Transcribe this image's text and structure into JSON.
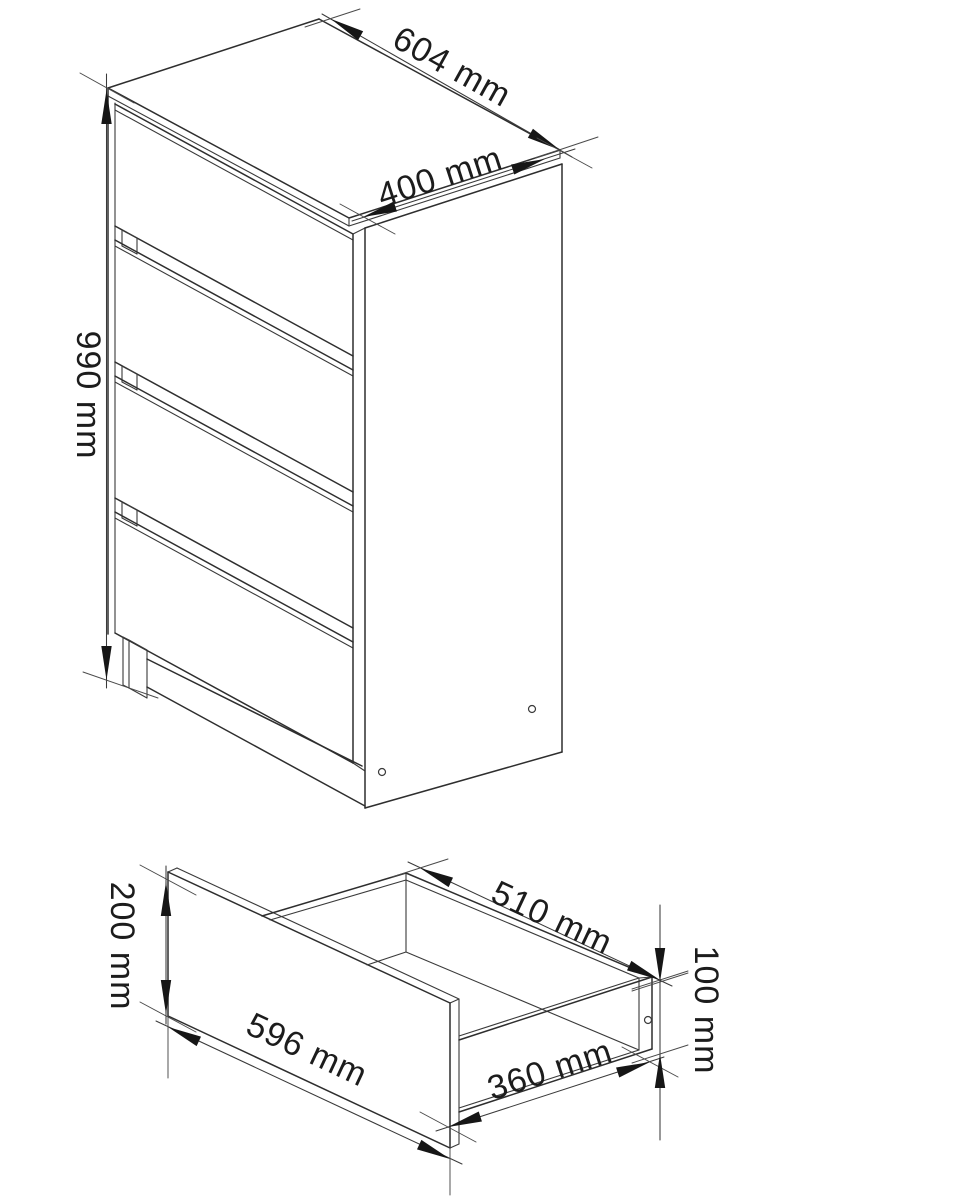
{
  "page": {
    "background": "#ffffff",
    "line_color": "#2e2e2e",
    "unit": "mm"
  },
  "figures": {
    "cabinet": {
      "description": "chest of drawers, isometric line drawing",
      "drawer_count": 4,
      "dims": {
        "width": {
          "label": "604 mm",
          "value": 604,
          "unit": "mm"
        },
        "depth": {
          "label": "400 mm",
          "value": 400,
          "unit": "mm"
        },
        "height": {
          "label": "990 mm",
          "value": 990,
          "unit": "mm"
        }
      }
    },
    "drawer": {
      "description": "single drawer box, isometric line drawing",
      "dims": {
        "front_height": {
          "label": "200 mm",
          "value": 200,
          "unit": "mm"
        },
        "front_width": {
          "label": "596 mm",
          "value": 596,
          "unit": "mm"
        },
        "inner_width": {
          "label": "510 mm",
          "value": 510,
          "unit": "mm"
        },
        "side_depth": {
          "label": "360 mm",
          "value": 360,
          "unit": "mm"
        },
        "box_height": {
          "label": "100 mm",
          "value": 100,
          "unit": "mm"
        }
      }
    }
  }
}
